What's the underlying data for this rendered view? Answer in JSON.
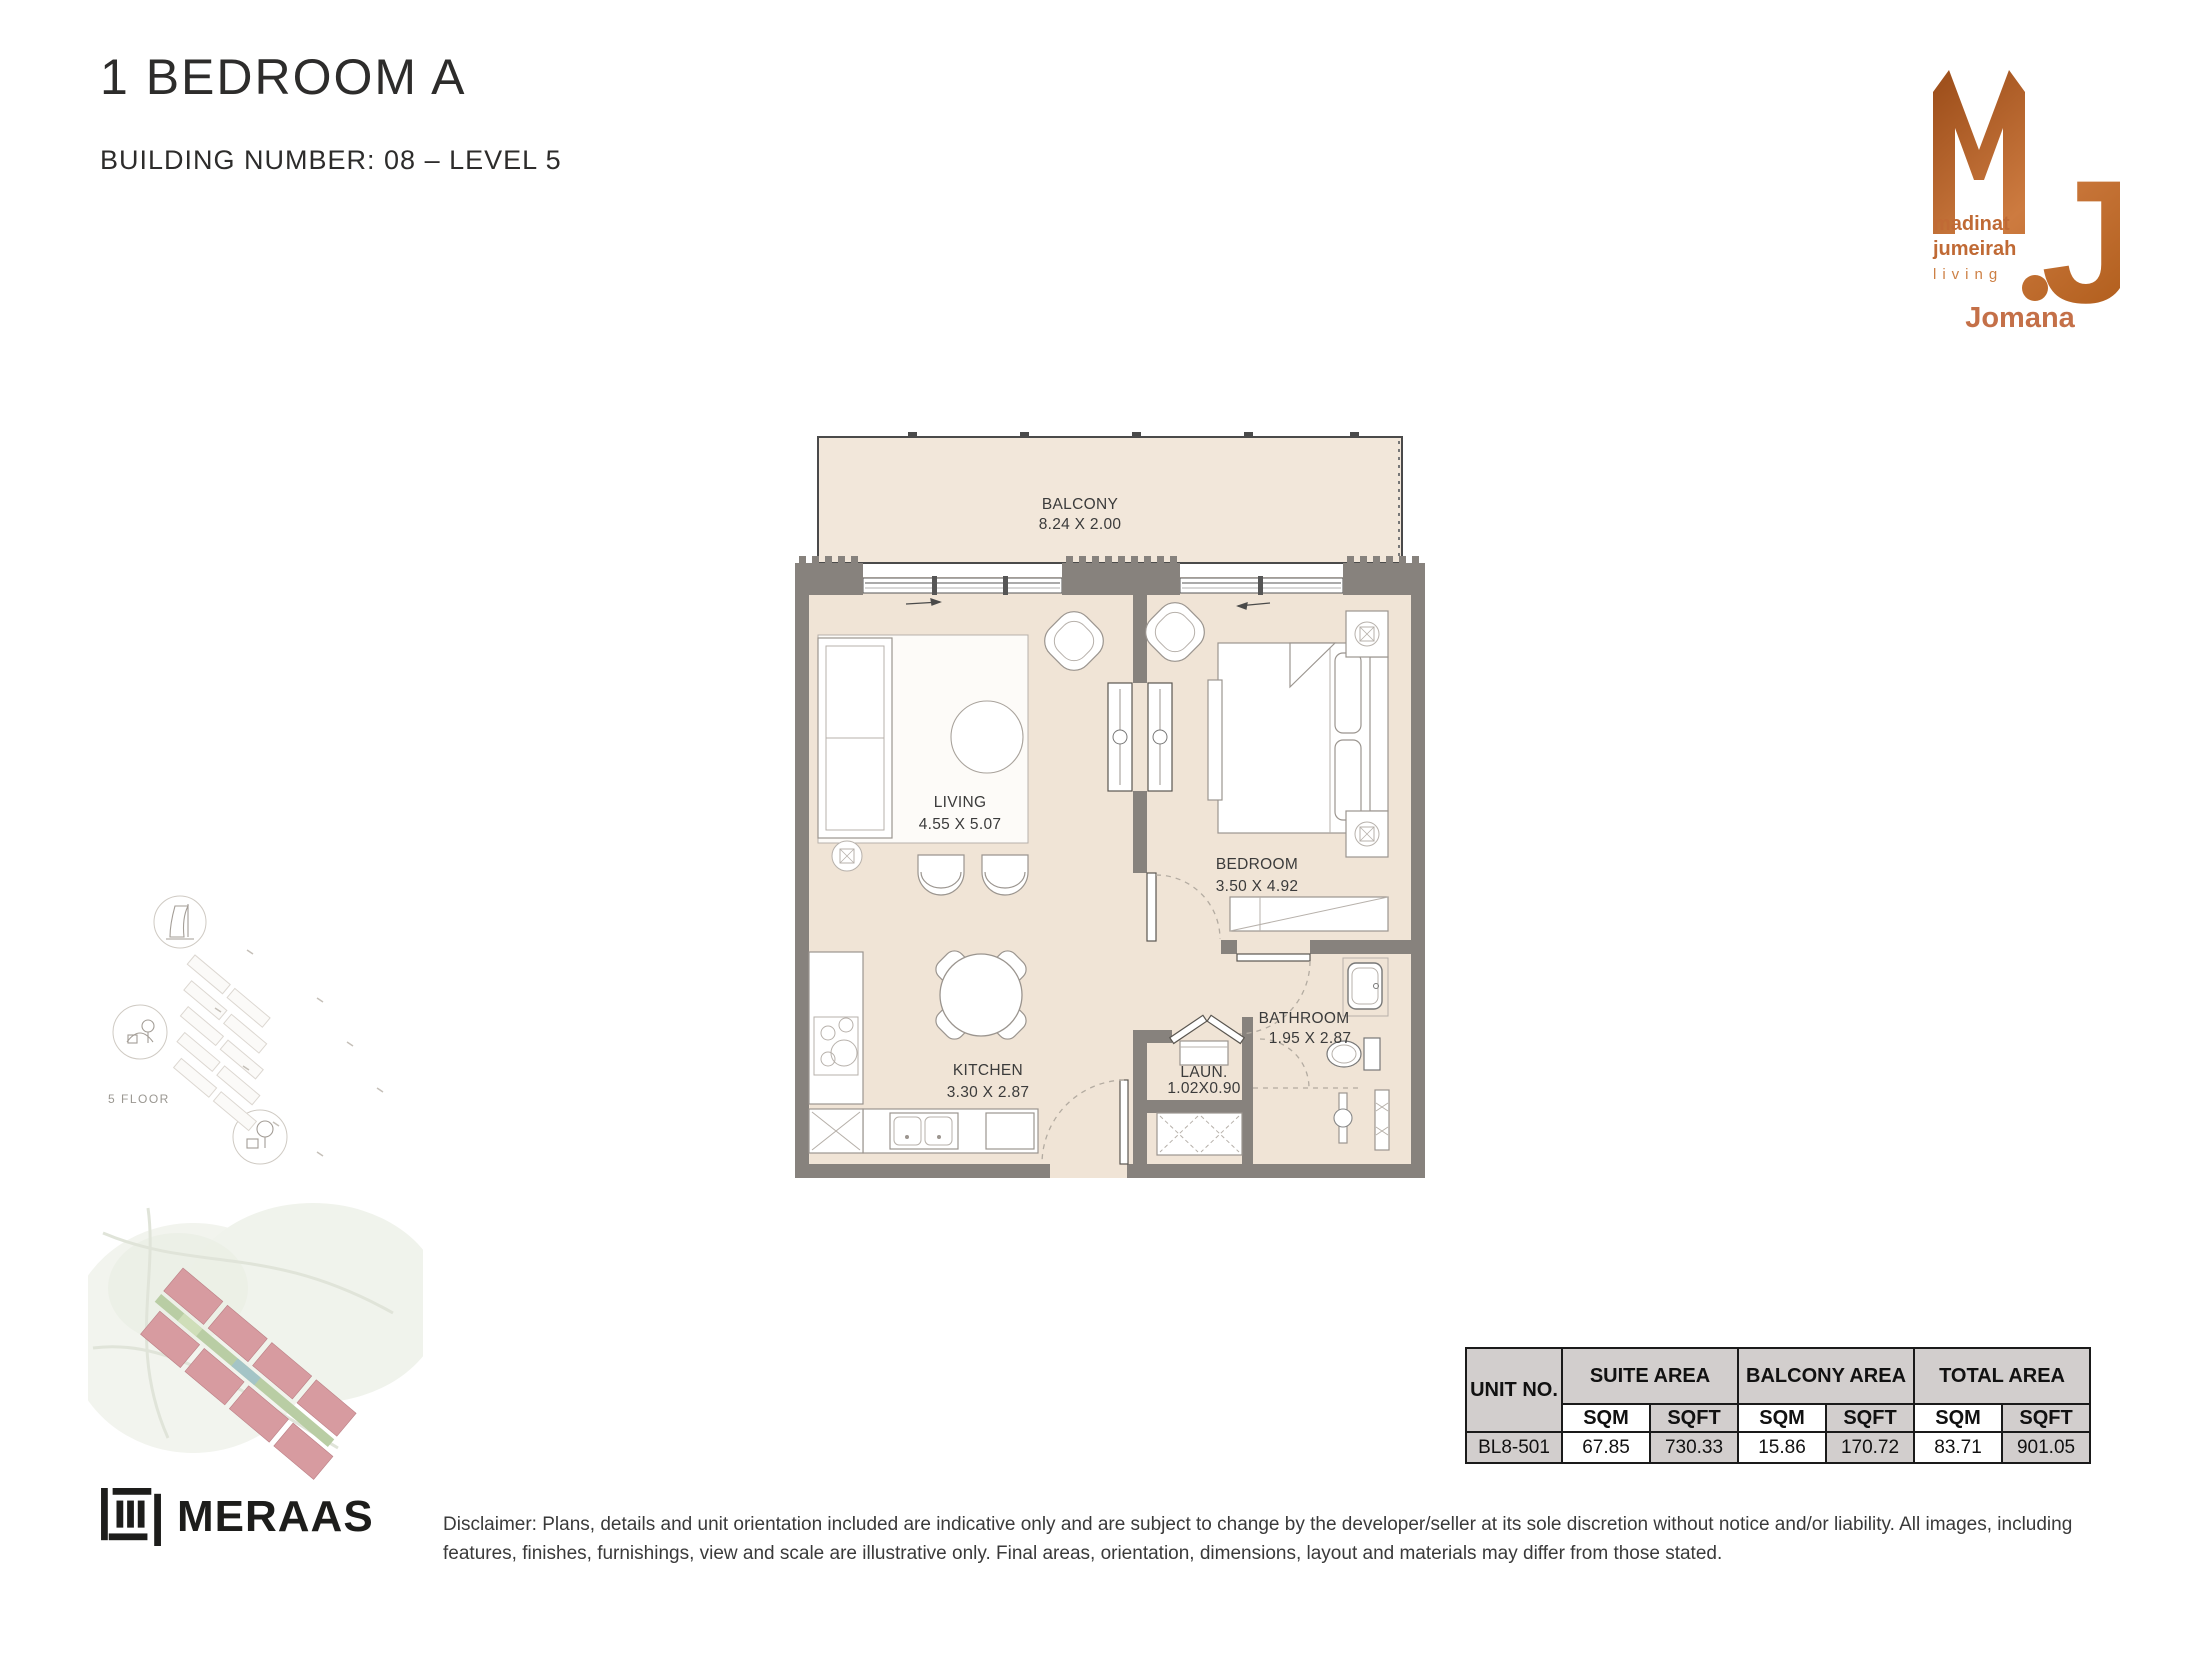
{
  "header": {
    "title": "1 BEDROOM A",
    "subtitle": "BUILDING NUMBER: 08 – LEVEL 5"
  },
  "brand": {
    "monogram": "MJ",
    "wordmark_line1": "madinat",
    "wordmark_line2": "jumeirah",
    "wordmark_line3": "living",
    "project_name": "Jomana",
    "copper_dark": "#a0511d",
    "copper_light": "#d8894e",
    "accent_text": "#c06a35"
  },
  "floorplan": {
    "rooms": [
      {
        "name": "BALCONY",
        "dims": "8.24 X 2.00"
      },
      {
        "name": "LIVING",
        "dims": "4.55 X 5.07"
      },
      {
        "name": "BEDROOM",
        "dims": "3.50 X 4.92"
      },
      {
        "name": "KITCHEN",
        "dims": "3.30 X 2.87"
      },
      {
        "name": "BATHROOM",
        "dims": "1.95 X 2.87"
      },
      {
        "name": "LAUN.",
        "dims": "1.02X0.90"
      }
    ],
    "colors": {
      "floor": "#f0e4d6",
      "balcony_floor": "#f2e7da",
      "wall": "#87827d",
      "furniture_line": "#9b958f"
    }
  },
  "site_plan": {
    "floor_label": "5 FLOOR",
    "building_color": "#d79ba0",
    "landscape_color": "#b9cda4"
  },
  "area_table": {
    "unit_header": "UNIT NO.",
    "groups": [
      "SUITE AREA",
      "BALCONY AREA",
      "TOTAL AREA"
    ],
    "sub_headers": [
      "SQM",
      "SQFT"
    ],
    "row": {
      "unit": "BL8-501",
      "suite_sqm": "67.85",
      "suite_sqft": "730.33",
      "balcony_sqm": "15.86",
      "balcony_sqft": "170.72",
      "total_sqm": "83.71",
      "total_sqft": "901.05"
    },
    "header_bg": "#d2cecd"
  },
  "footer": {
    "developer": "MERAAS",
    "disclaimer": "Disclaimer: Plans, details and unit orientation included are indicative only and are subject to change by the developer/seller at its sole discretion without notice and/or liability. All images, including features, finishes, furnishings, view and scale are illustrative only. Final areas, orientation, dimensions, layout and materials may differ from those stated."
  }
}
